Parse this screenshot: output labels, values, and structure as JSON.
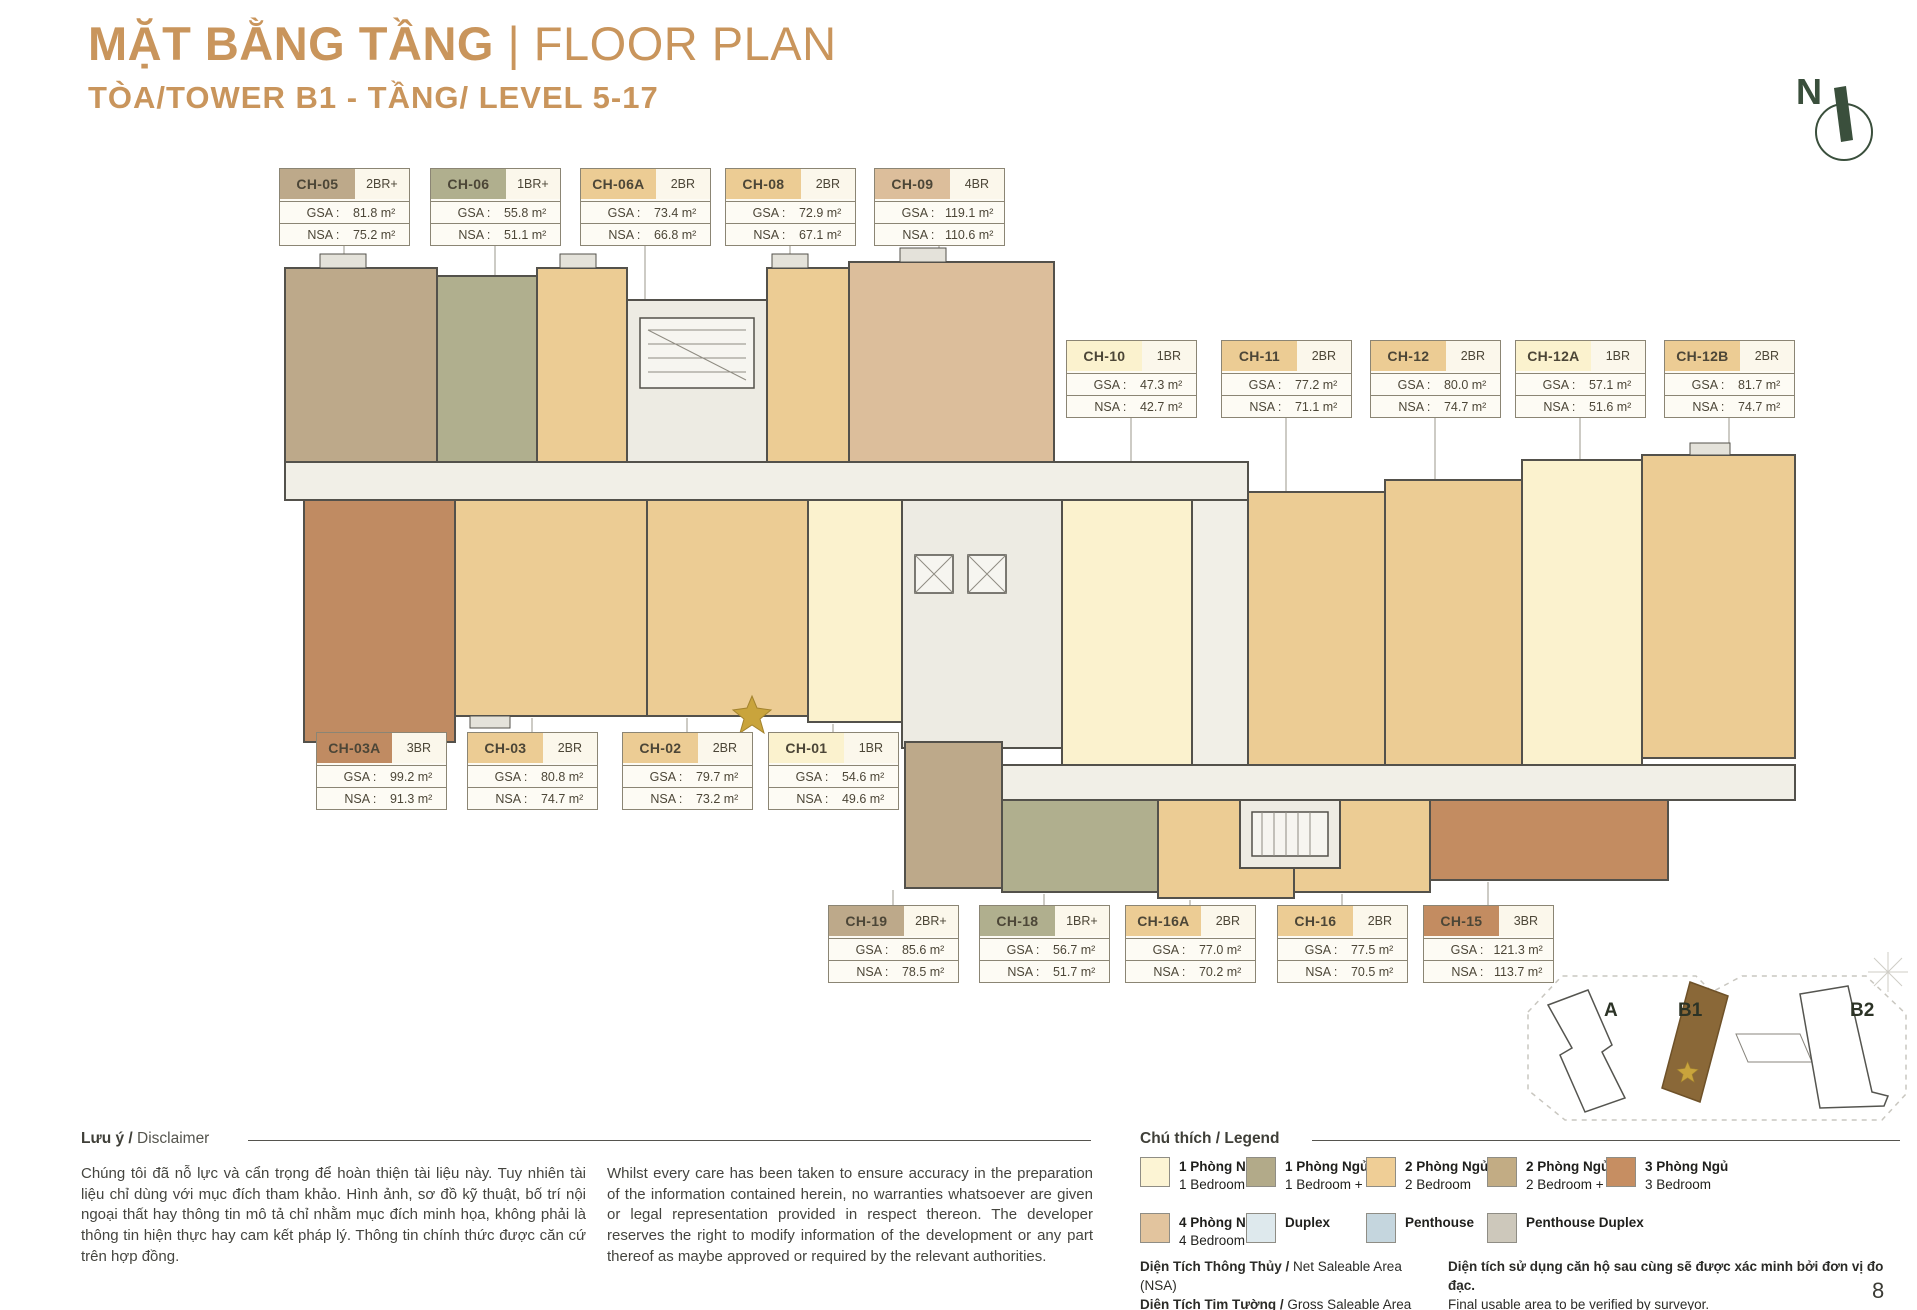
{
  "page": {
    "number": "8"
  },
  "header": {
    "title_vi": "MẶT BẰNG TẦNG",
    "title_en": " | FLOOR PLAN",
    "subtitle": "TÒA/TOWER B1 - TẦNG/ LEVEL 5-17",
    "accent_color": "#C9955C",
    "compass_letter": "N"
  },
  "labels": {
    "gsa": "GSA :",
    "nsa": "NSA :"
  },
  "plan": {
    "corridor": "#F1EFE7",
    "core": "#EDEBE3",
    "wall": "#53514B",
    "leader": "#ABA89E",
    "star_gold": "#C9A43C"
  },
  "units": [
    {
      "code": "CH-05",
      "type": "2BR+",
      "gsa": "81.8 m²",
      "nsa": "75.2 m²",
      "color": "#BDA98A"
    },
    {
      "code": "CH-06",
      "type": "1BR+",
      "gsa": "55.8 m²",
      "nsa": "51.1 m²",
      "color": "#B0AF8E"
    },
    {
      "code": "CH-06A",
      "type": "2BR",
      "gsa": "73.4 m²",
      "nsa": "66.8 m²",
      "color": "#ECCC94"
    },
    {
      "code": "CH-08",
      "type": "2BR",
      "gsa": "72.9 m²",
      "nsa": "67.1 m²",
      "color": "#ECCC94"
    },
    {
      "code": "CH-09",
      "type": "4BR",
      "gsa": "119.1 m²",
      "nsa": "110.6 m²",
      "color": "#DCBE9B"
    },
    {
      "code": "CH-10",
      "type": "1BR",
      "gsa": "47.3 m²",
      "nsa": "42.7 m²",
      "color": "#FBF2CE"
    },
    {
      "code": "CH-11",
      "type": "2BR",
      "gsa": "77.2 m²",
      "nsa": "71.1 m²",
      "color": "#ECCC94"
    },
    {
      "code": "CH-12",
      "type": "2BR",
      "gsa": "80.0 m²",
      "nsa": "74.7 m²",
      "color": "#ECCC94"
    },
    {
      "code": "CH-12A",
      "type": "1BR",
      "gsa": "57.1 m²",
      "nsa": "51.6 m²",
      "color": "#FBF2CE"
    },
    {
      "code": "CH-12B",
      "type": "2BR",
      "gsa": "81.7 m²",
      "nsa": "74.7 m²",
      "color": "#ECCC94"
    },
    {
      "code": "CH-03A",
      "type": "3BR",
      "gsa": "99.2 m²",
      "nsa": "91.3 m²",
      "color": "#C08B62"
    },
    {
      "code": "CH-03",
      "type": "2BR",
      "gsa": "80.8 m²",
      "nsa": "74.7 m²",
      "color": "#ECCC94"
    },
    {
      "code": "CH-02",
      "type": "2BR",
      "gsa": "79.7 m²",
      "nsa": "73.2 m²",
      "color": "#ECCC94"
    },
    {
      "code": "CH-01",
      "type": "1BR",
      "gsa": "54.6 m²",
      "nsa": "49.6 m²",
      "color": "#FBF2CE"
    },
    {
      "code": "CH-19",
      "type": "2BR+",
      "gsa": "85.6 m²",
      "nsa": "78.5 m²",
      "color": "#BDA98A"
    },
    {
      "code": "CH-18",
      "type": "1BR+",
      "gsa": "56.7 m²",
      "nsa": "51.7 m²",
      "color": "#B0AF8E"
    },
    {
      "code": "CH-16A",
      "type": "2BR",
      "gsa": "77.0 m²",
      "nsa": "70.2 m²",
      "color": "#ECCC94"
    },
    {
      "code": "CH-16",
      "type": "2BR",
      "gsa": "77.5 m²",
      "nsa": "70.5 m²",
      "color": "#ECCC94"
    },
    {
      "code": "CH-15",
      "type": "3BR",
      "gsa": "121.3 m²",
      "nsa": "113.7 m²",
      "color": "#C38C61"
    }
  ],
  "disclaimer": {
    "header_vi": "Lưu ý /",
    "header_en": " Disclaimer",
    "text_vi": "Chúng tôi đã nỗ lực và cẩn trọng để hoàn thiện tài liệu này. Tuy nhiên tài liệu chỉ dùng với mục đích tham khảo. Hình ảnh, sơ đồ kỹ thuật, bố trí nội ngoại thất hay thông tin mô tả chỉ nhằm mục đích minh họa, không phải là thông tin hiện thực hay cam kết pháp lý. Thông tin chính thức được căn cứ trên hợp đồng.",
    "text_en": "Whilst every care has been taken to ensure accuracy in the preparation of the information contained herein, no warranties whatsoever are given or legal representation provided in respect thereon. The developer reserves the right to modify information of the development or any part thereof as maybe approved or required by the relevant authorities."
  },
  "legend": {
    "header_vi": "Chú thích /",
    "header_en": " Legend",
    "items": [
      {
        "vi": "1 Phòng Ngủ",
        "en": "1 Bedroom",
        "color": "#FCF4D4"
      },
      {
        "vi": "1 Phòng Ngủ +",
        "en": "1 Bedroom +",
        "color": "#B2AA89"
      },
      {
        "vi": "2 Phòng Ngủ",
        "en": "2 Bedroom",
        "color": "#EFCE96"
      },
      {
        "vi": "2 Phòng Ngủ +",
        "en": "2 Bedroom +",
        "color": "#C2AC84"
      },
      {
        "vi": "3 Phòng Ngủ",
        "en": "3 Bedroom",
        "color": "#C68E62"
      },
      {
        "vi": "4 Phòng Ngủ",
        "en": "4 Bedroom",
        "color": "#E2C49E"
      },
      {
        "vi": "Duplex",
        "en": "",
        "color": "#DEE9ED"
      },
      {
        "vi": "Penthouse",
        "en": "",
        "color": "#C5D6DE"
      },
      {
        "vi": "Penthouse Duplex",
        "en": "",
        "color": "#CDC8BB"
      }
    ]
  },
  "footnotes": {
    "nsa_vi": "Diện Tích Thông Thủy /",
    "nsa_en": " Net Saleable Area (NSA)",
    "gsa_vi": "Diện Tích Tim Tường /",
    "gsa_en": " Gross Saleable Area (GSA)",
    "note_vi": "Diện tích sử dụng căn hộ sau cùng sẽ được xác minh bởi đơn vị đo đạc.",
    "note_en": "Final usable area to be verified by surveyor."
  },
  "sitemap": {
    "towers": [
      "A",
      "B1",
      "B2"
    ],
    "highlight_color": "#8A6838"
  }
}
